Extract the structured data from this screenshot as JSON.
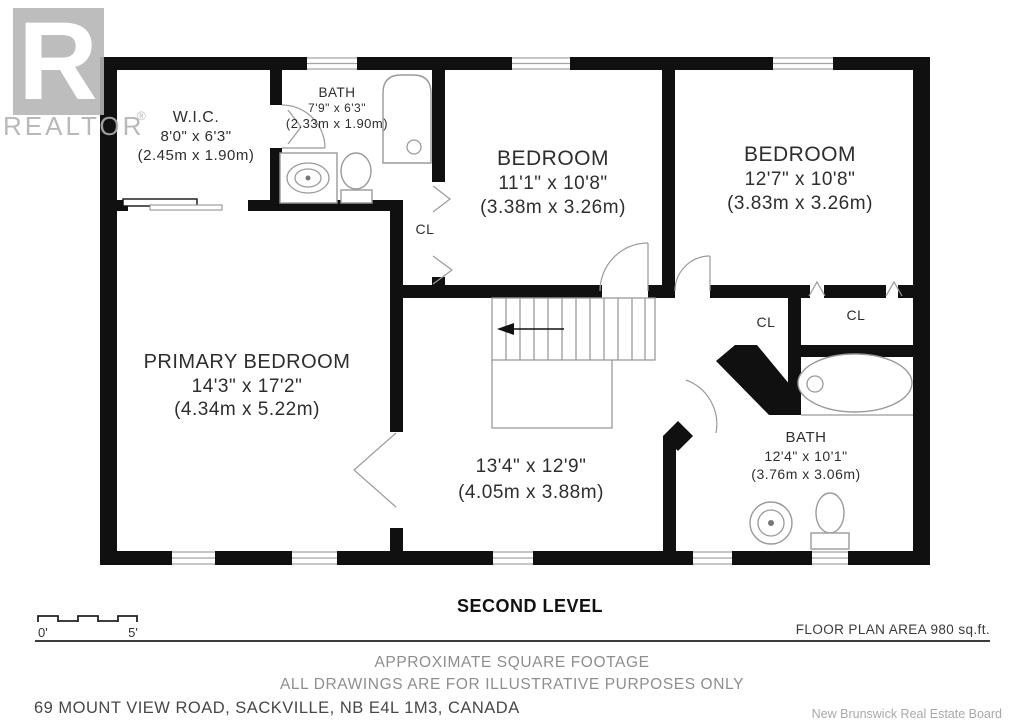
{
  "colors": {
    "wall": "#101010",
    "thin_line": "#9a9a9a",
    "label_text": "#2e2e2e",
    "footer_gray": "#8e8e8e",
    "logo_gray": "#b5b5b5",
    "attribution_gray": "#a9a9a9"
  },
  "logo": {
    "letter": "R",
    "name": "REALTOR",
    "registered": "®"
  },
  "plan": {
    "closet_label": "CL",
    "rooms": {
      "wic": {
        "name": "W.I.C.",
        "imperial": "8'0\" x 6'3\"",
        "metric": "(2.45m x 1.90m)"
      },
      "bath_top": {
        "name": "BATH",
        "imperial": "7'9\" x 6'3\"",
        "metric": "(2.33m x 1.90m)"
      },
      "bedroom_mid": {
        "name": "BEDROOM",
        "imperial": "11'1\" x 10'8\"",
        "metric": "(3.38m x 3.26m)"
      },
      "bedroom_right": {
        "name": "BEDROOM",
        "imperial": "12'7\" x 10'8\"",
        "metric": "(3.83m x 3.26m)"
      },
      "primary": {
        "name": "PRIMARY BEDROOM",
        "imperial": "14'3\" x 17'2\"",
        "metric": "(4.34m x 5.22m)"
      },
      "hall": {
        "imperial": "13'4\" x 12'9\"",
        "metric": "(4.05m x 3.88m)"
      },
      "bath_main": {
        "name": "BATH",
        "imperial": "12'4\" x 10'1\"",
        "metric": "(3.76m x 3.06m)"
      }
    }
  },
  "footer": {
    "level_title": "SECOND LEVEL",
    "scale_start": "0'",
    "scale_end": "5'",
    "floor_area": "FLOOR PLAN AREA 980 sq.ft.",
    "disclaimer_line1": "APPROXIMATE SQUARE FOOTAGE",
    "disclaimer_line2": "ALL DRAWINGS ARE FOR ILLUSTRATIVE PURPOSES ONLY",
    "address": "69 MOUNT VIEW ROAD, SACKVILLE, NB E4L 1M3, CANADA",
    "attribution": "New Brunswick Real Estate Board"
  }
}
